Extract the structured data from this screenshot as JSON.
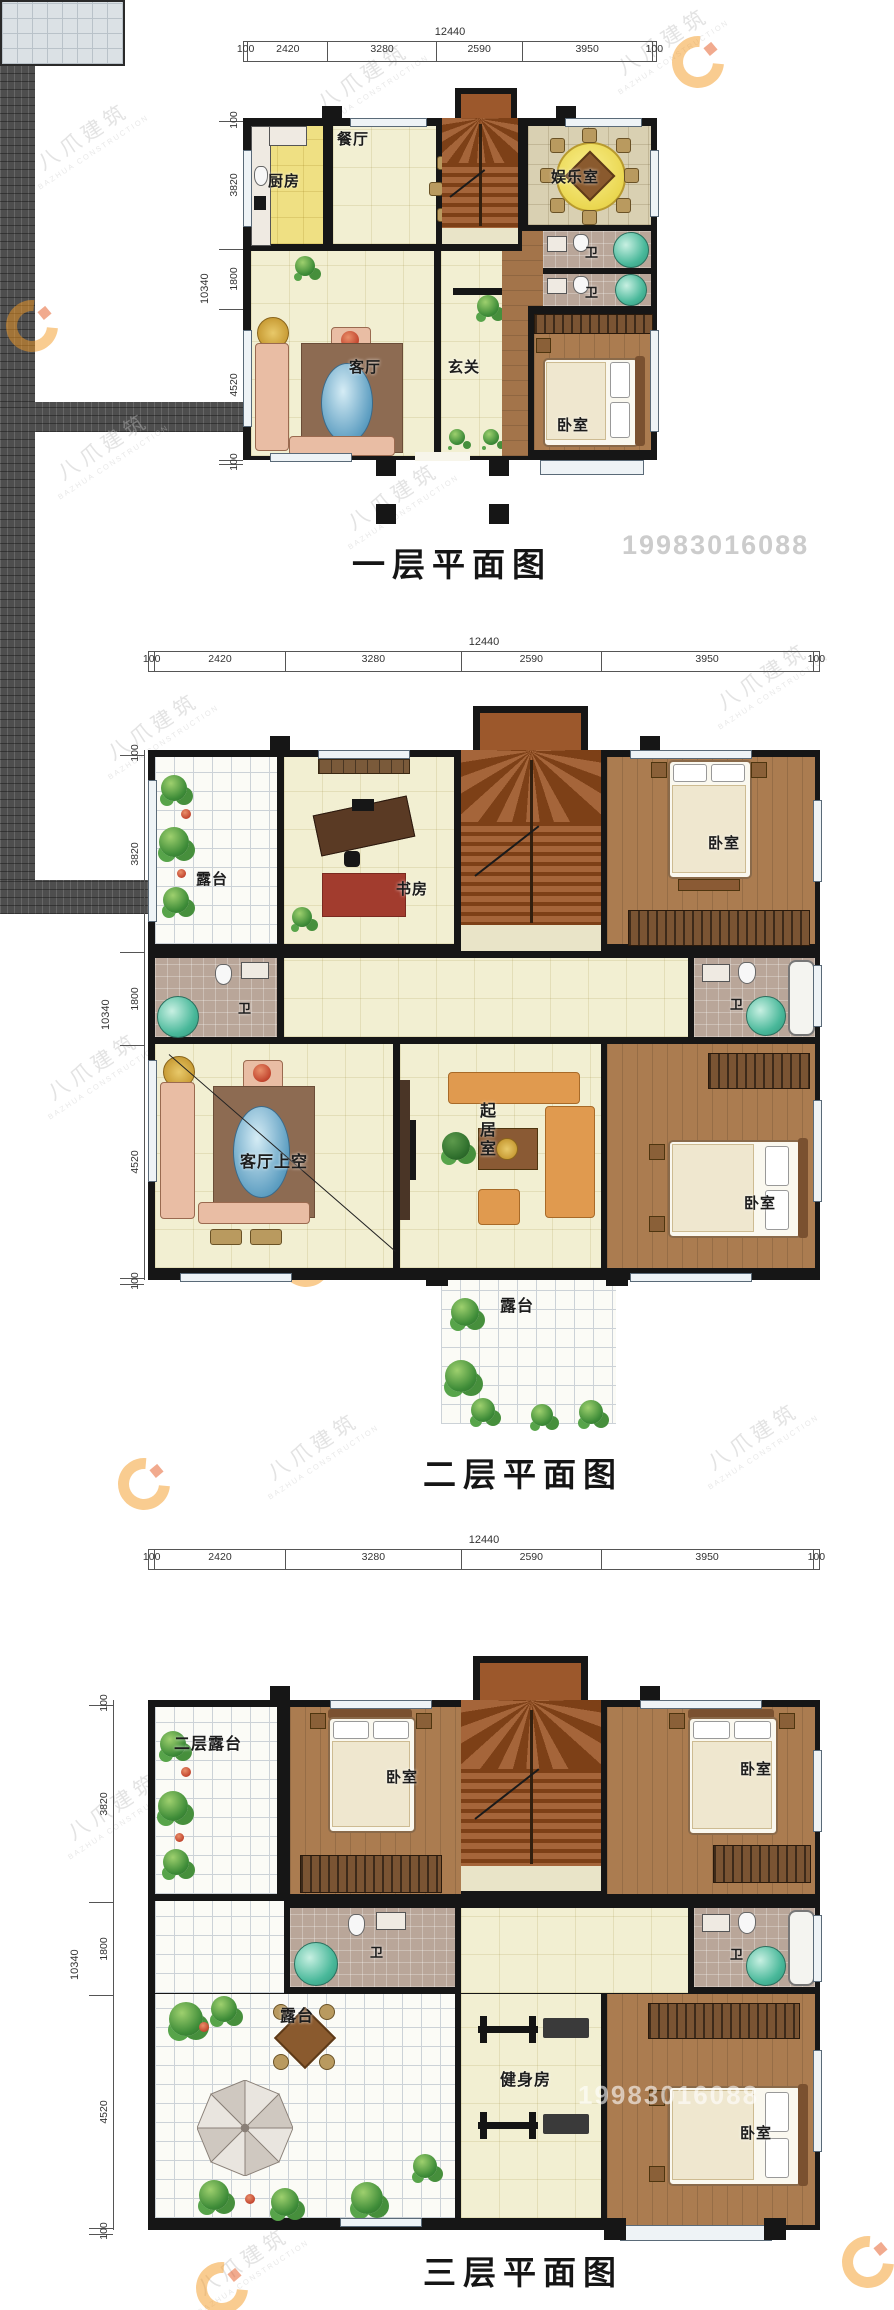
{
  "watermark": {
    "brand": "八爪建筑",
    "brand_sub": "BAZHUA CONSTRUCTION",
    "phone": "19983016088",
    "logo_color": "#f59a23"
  },
  "dims": {
    "total_width": "12440",
    "top_segments": [
      "100",
      "2420",
      "3280",
      "2590",
      "3950",
      "100"
    ],
    "total_height": "10340",
    "left_segments": [
      "100",
      "3820",
      "1800",
      "4520",
      "100"
    ]
  },
  "floors": [
    {
      "title": "一层平面图",
      "rooms": {
        "kitchen": "厨房",
        "dining": "餐厅",
        "entertainment": "娱乐室",
        "bath_upper": "卫",
        "bath_lower": "卫",
        "living": "客厅",
        "foyer": "玄关",
        "bedroom": "卧室"
      }
    },
    {
      "title": "二层平面图",
      "rooms": {
        "terrace_top": "露台",
        "study": "书房",
        "bedroom_top": "卧室",
        "bath_left": "卫",
        "bath_right": "卫",
        "living_void": "客厅上空",
        "sitting": "起居室",
        "bedroom_bottom": "卧室",
        "terrace_bottom": "露台"
      }
    },
    {
      "title": "三层平面图",
      "rooms": {
        "terrace_top": "二层露台",
        "bedroom_top_center": "卧室",
        "bedroom_top_right": "卧室",
        "bath_left": "卫",
        "bath_right": "卫",
        "terrace": "露台",
        "gym": "健身房",
        "bedroom_bottom": "卧室"
      }
    }
  ]
}
